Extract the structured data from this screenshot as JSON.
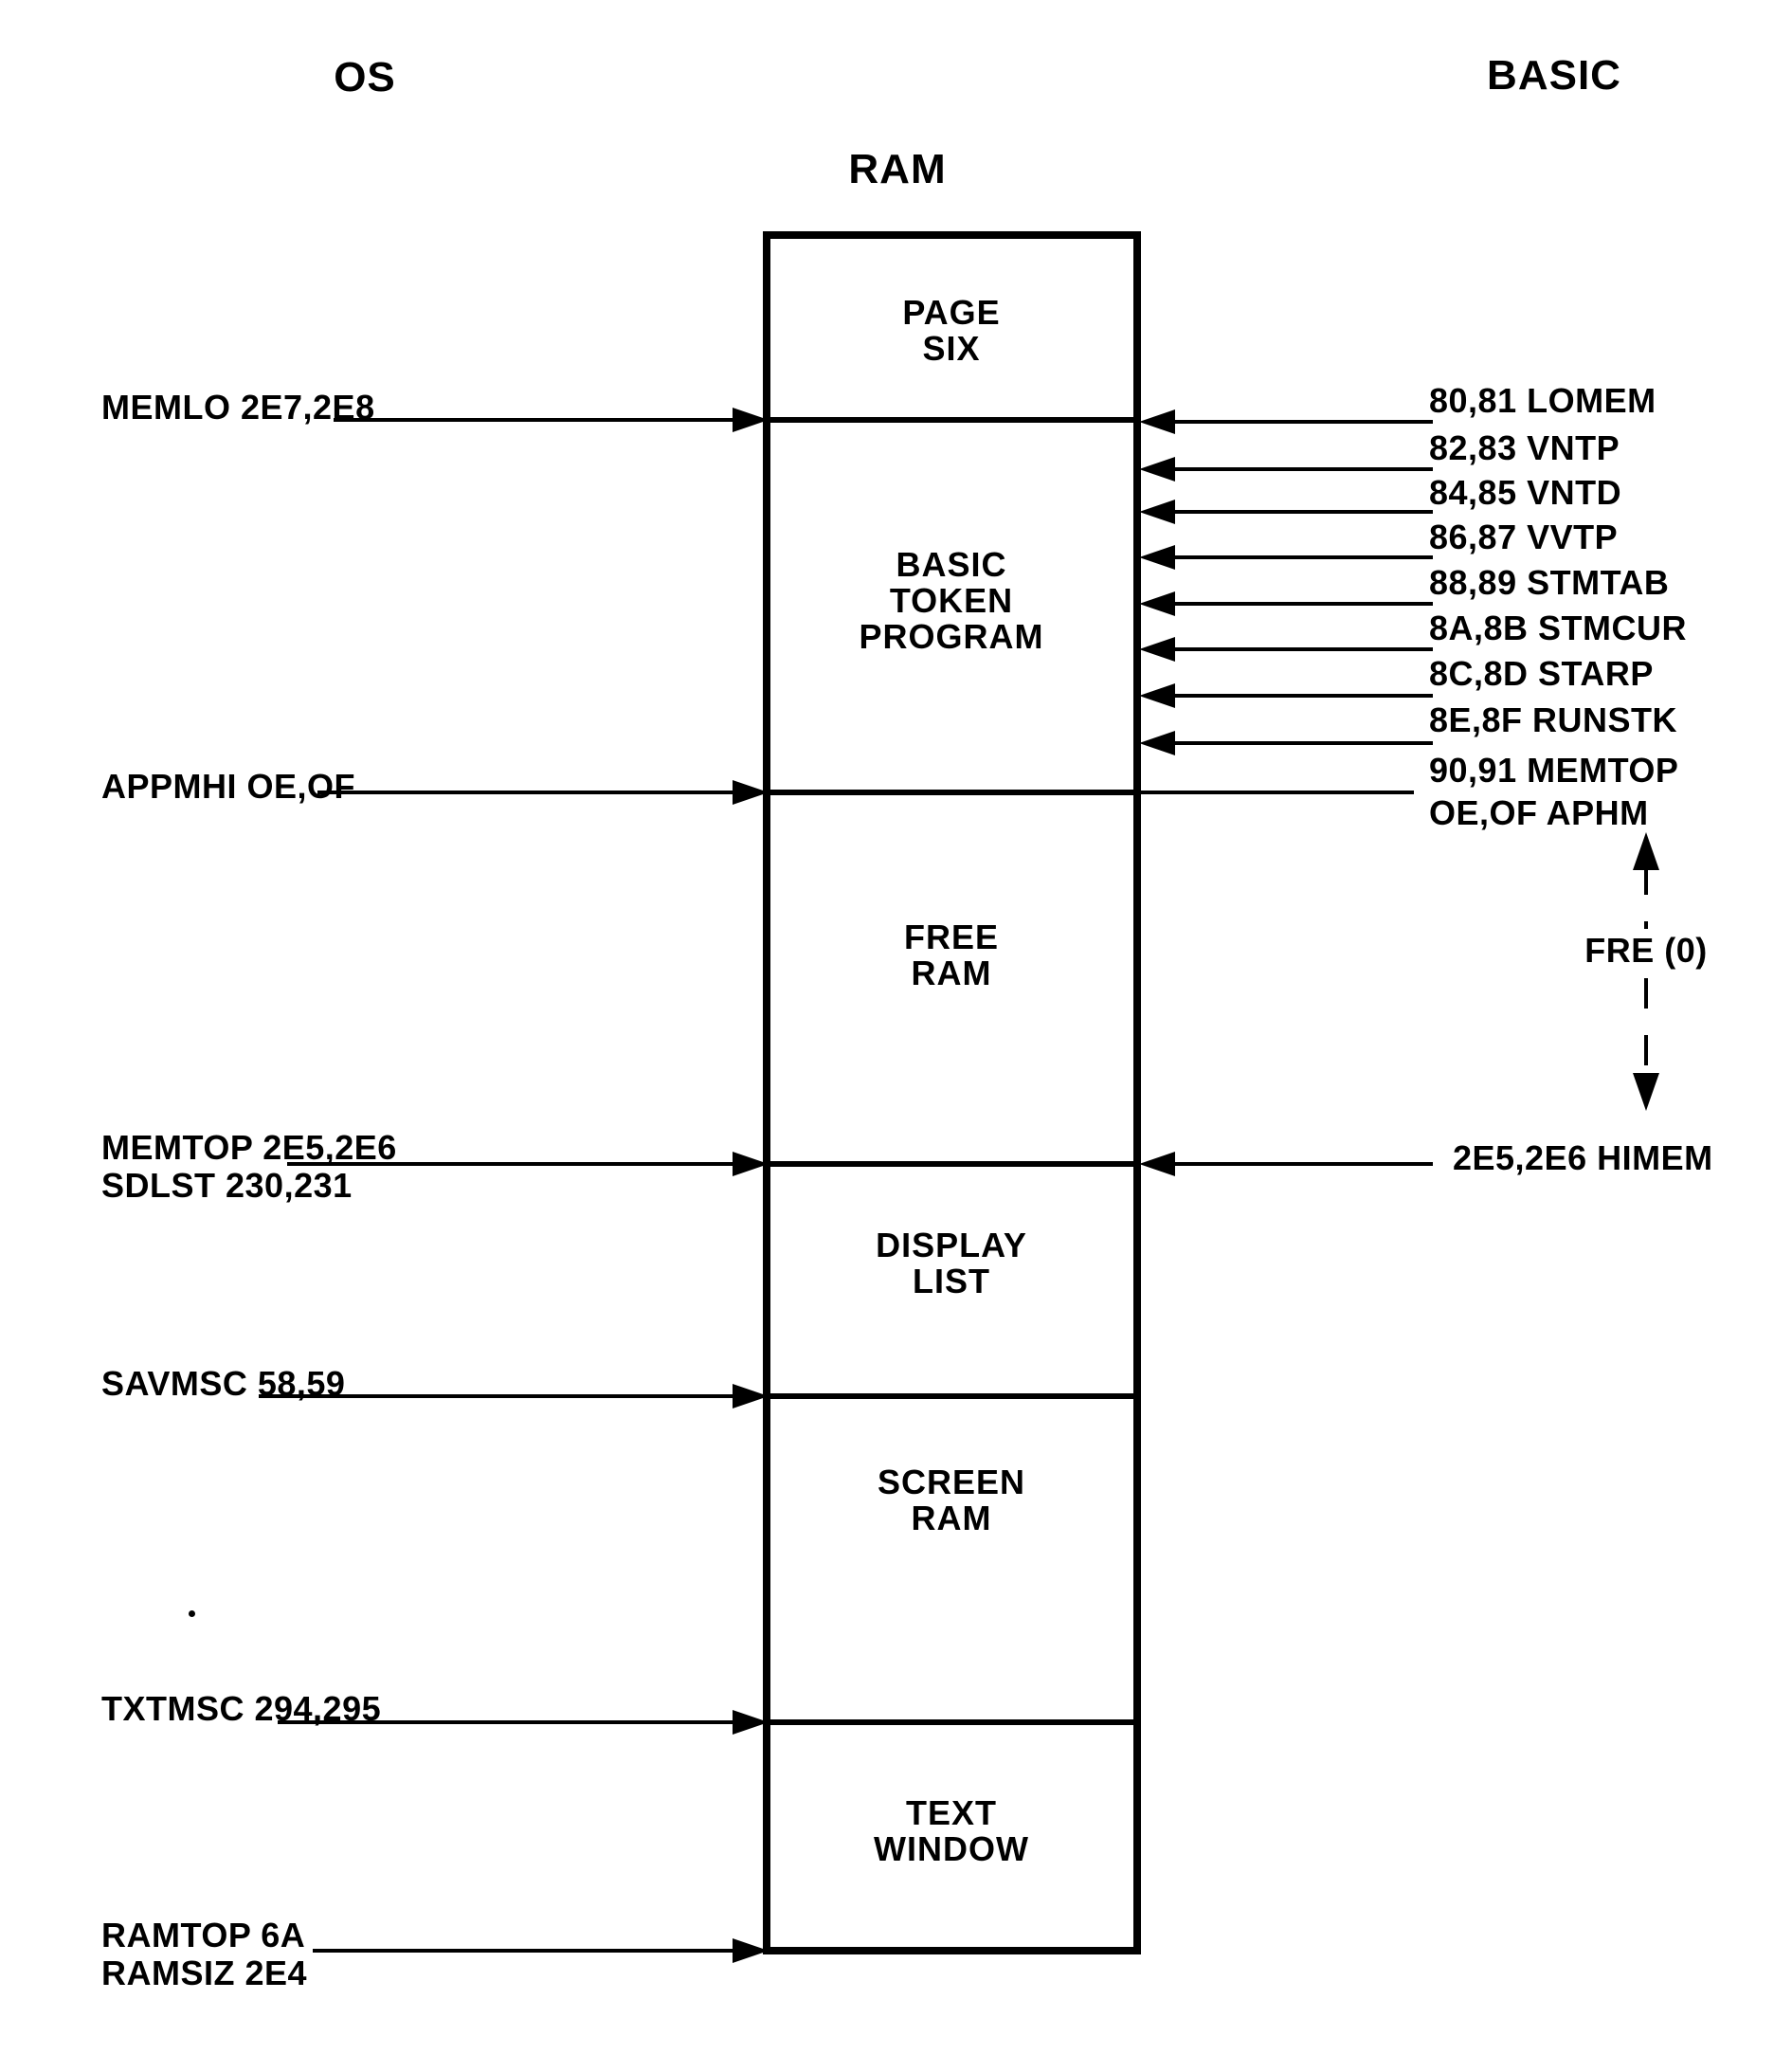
{
  "colors": {
    "ink": "#000000",
    "paper": "#ffffff"
  },
  "headers": {
    "os": "OS",
    "ram": "RAM",
    "basic": "BASIC"
  },
  "memory_box": {
    "sections": [
      {
        "name": "page-six",
        "label": "PAGE\nSIX"
      },
      {
        "name": "basic-token-program",
        "label": "BASIC\nTOKEN\nPROGRAM"
      },
      {
        "name": "free-ram",
        "label": "FREE\nRAM"
      },
      {
        "name": "display-list",
        "label": "DISPLAY\nLIST"
      },
      {
        "name": "screen-ram",
        "label": "SCREEN\nRAM"
      },
      {
        "name": "text-window",
        "label": "TEXT\nWINDOW"
      }
    ]
  },
  "os_pointers": [
    {
      "label": "MEMLO 2E7,2E8"
    },
    {
      "label": "APPMHI OE,OF"
    },
    {
      "label": "MEMTOP 2E5,2E6\nSDLST 230,231"
    },
    {
      "label": "SAVMSC 58,59"
    },
    {
      "label": "TXTMSC 294,295"
    },
    {
      "label": "RAMTOP 6A\nRAMSIZ 2E4"
    }
  ],
  "basic_pointers": [
    {
      "label": "80,81 LOMEM"
    },
    {
      "label": "82,83 VNTP"
    },
    {
      "label": "84,85 VNTD"
    },
    {
      "label": "86,87 VVTP"
    },
    {
      "label": "88,89 STMTAB"
    },
    {
      "label": "8A,8B STMCUR"
    },
    {
      "label": "8C,8D STARP"
    },
    {
      "label": "8E,8F RUNSTK"
    },
    {
      "label": "90,91 MEMTOP"
    },
    {
      "label": "OE,OF APHM"
    },
    {
      "label": "2E5,2E6 HIMEM"
    }
  ],
  "free_region": {
    "label": "FRE (0)"
  }
}
